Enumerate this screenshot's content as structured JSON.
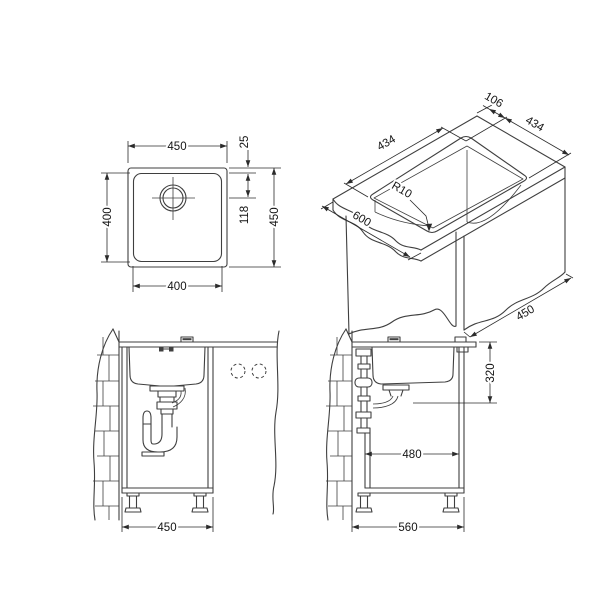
{
  "title": "Undermount sink installation technical drawing",
  "colors": {
    "line": "#3f3f3f",
    "dim": "#2b2b2b",
    "txt": "#141414",
    "bg": "#ffffff"
  },
  "views": {
    "top": {
      "name": "top view of sink",
      "width_top": "450",
      "bowl_height": "400",
      "bowl_width": "400",
      "rim": "25",
      "drain_offset": "118",
      "height_right": "450"
    },
    "iso": {
      "name": "worktop cutout isometric view",
      "edge_offset": "106",
      "cutout_width": "434",
      "cutout_depth": "434",
      "corner_radius": "R10",
      "counter_depth": "600",
      "panel_width": "450"
    },
    "front": {
      "name": "front view in cabinet",
      "cabinet_width": "450"
    },
    "side": {
      "name": "side view in cabinet",
      "clearance_depth": "320",
      "inner_depth": "480",
      "cabinet_depth": "560"
    }
  }
}
